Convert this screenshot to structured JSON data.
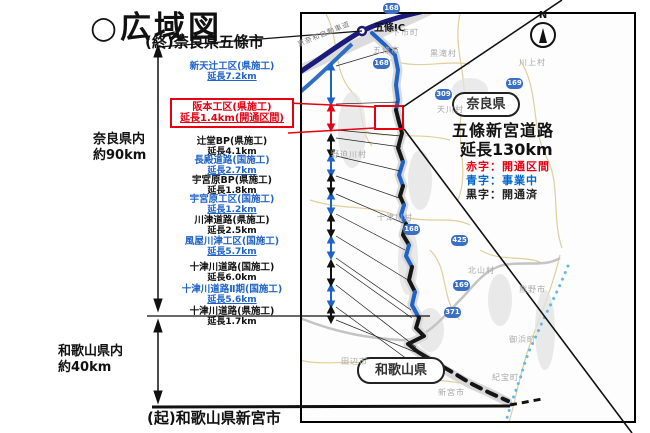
{
  "title": "○広域図",
  "endpoint_top": "(終)奈良県五條市",
  "endpoint_bottom": "(起)和歌山県新宮市",
  "extents": {
    "nara": {
      "area": "奈良県内",
      "length": "約90km"
    },
    "wakayama": {
      "area": "和歌山県内",
      "length": "約40km"
    }
  },
  "road_summary": {
    "name": "五條新宮道路",
    "length": "延長130km"
  },
  "legend": {
    "items": [
      {
        "text": "赤字：開通区間",
        "color": "#e60012"
      },
      {
        "text": "青字：事業中",
        "color": "#0066cc"
      },
      {
        "text": "黒字：開通済",
        "color": "#222222"
      }
    ]
  },
  "segments": [
    {
      "name": "新天辻工区(県施工)",
      "length": "延長7.2km",
      "status": "事業中",
      "color": "#1f63c8"
    },
    {
      "name": "阪本工区(県施工)",
      "length": "延長1.4km(開通区間)",
      "status": "開通区間",
      "color": "#e60012"
    },
    {
      "name": "辻堂BP(県施工)",
      "length": "延長4.1km",
      "status": "開通済",
      "color": "#111111"
    },
    {
      "name": "長殿道路(国施工)",
      "length": "延長2.7km",
      "status": "事業中",
      "color": "#1f63c8"
    },
    {
      "name": "宇宮原BP(県施工)",
      "length": "延長1.8km",
      "status": "開通済",
      "color": "#111111"
    },
    {
      "name": "宇宮原工区(国施工)",
      "length": "延長1.2km",
      "status": "事業中",
      "color": "#1f63c8"
    },
    {
      "name": "川津道路(県施工)",
      "length": "延長2.5km",
      "status": "開通済",
      "color": "#111111"
    },
    {
      "name": "風屋川津工区(国施工)",
      "length": "延長5.7km",
      "status": "事業中",
      "color": "#1f63c8"
    },
    {
      "name": "十津川道路(国施工)",
      "length": "延長6.0km",
      "status": "開通済",
      "color": "#111111"
    },
    {
      "name": "十津川道路Ⅱ期(国施工)",
      "length": "延長5.6km",
      "status": "事業中",
      "color": "#1f63c8"
    },
    {
      "name": "十津川道路(県施工)",
      "length": "延長1.7km",
      "status": "開通済",
      "color": "#111111"
    }
  ],
  "map": {
    "prefectures": [
      {
        "name": "奈良県"
      },
      {
        "name": "和歌山県"
      }
    ],
    "ic": "五條IC",
    "expressway": "京奈和自動車道",
    "compass_n": "N",
    "places": [
      {
        "name": "下市町"
      },
      {
        "name": "五條市"
      },
      {
        "name": "黒滝村"
      },
      {
        "name": "川上村"
      },
      {
        "name": "天川村"
      },
      {
        "name": "野迫川村"
      },
      {
        "name": "十津川村"
      },
      {
        "name": "北山村"
      },
      {
        "name": "熊野市"
      },
      {
        "name": "御浜町"
      },
      {
        "name": "紀宝町"
      },
      {
        "name": "新宮市"
      },
      {
        "name": "田辺市"
      }
    ],
    "shields": [
      {
        "number": "168"
      },
      {
        "number": "168"
      },
      {
        "number": "309"
      },
      {
        "number": "169"
      },
      {
        "number": "168"
      },
      {
        "number": "425"
      },
      {
        "number": "169"
      },
      {
        "number": "371"
      }
    ]
  }
}
